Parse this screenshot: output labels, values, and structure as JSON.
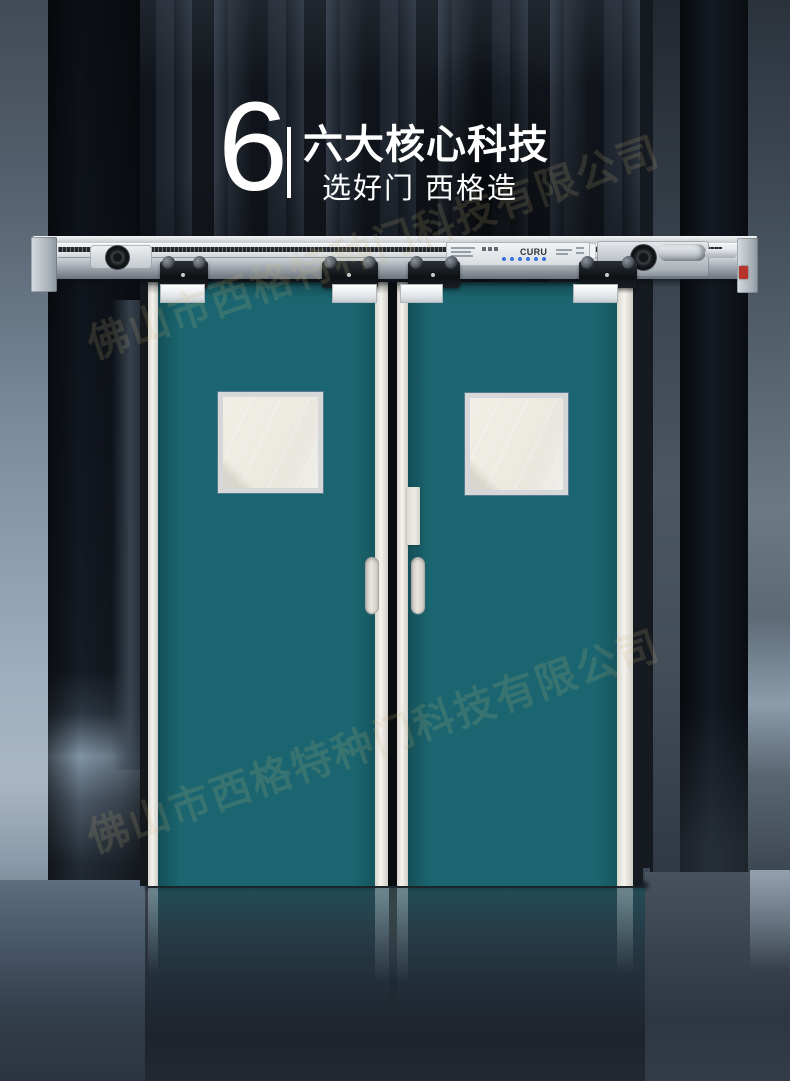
{
  "header": {
    "number": "6",
    "title": "六大核心科技",
    "subtitle": "选好门 西格造"
  },
  "watermark": {
    "text": "佛山市西格特种门科技有限公司"
  },
  "rail": {
    "brand": "CURU"
  },
  "colors": {
    "door": "#1a656f",
    "rail_silver": "#dfe3e6",
    "background": "#14181e",
    "led_blue": "#3a6fd8",
    "motor_red": "#b5342c",
    "text_white": "#ffffff"
  }
}
